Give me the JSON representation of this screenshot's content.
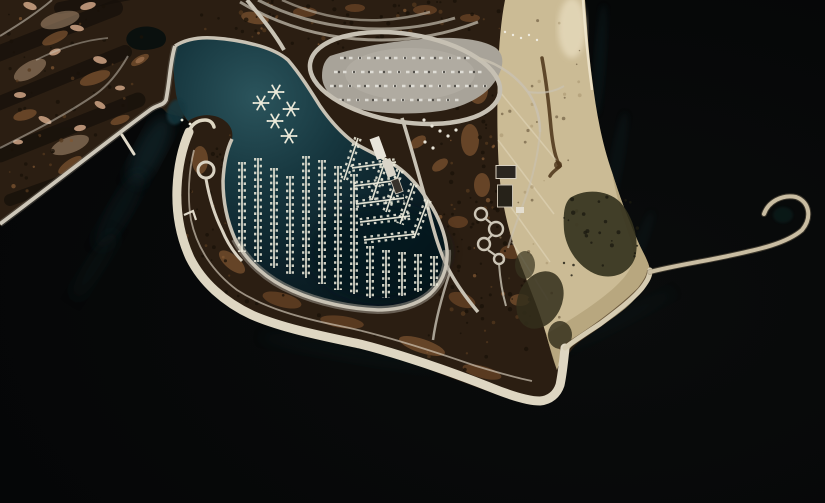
{
  "scene": {
    "type": "satellite-aerial-photograph",
    "description": "Aerial satellite view of a lakefront harbor: golf course at upper left, teardrop marina basin with star-shaped docks and boat piers, hooked peninsula breakwater with loop drive at its tip, looped parking lot and parkland at top, sandy beach strip at right, and a thin spiral breakwater curling into dark lake water",
    "features": [
      "golf-course",
      "marina-basin",
      "star-docks",
      "boat-piers",
      "hooked-peninsula",
      "harbor-entrance",
      "parking-lot",
      "loop-road",
      "parkland",
      "beach",
      "beach-point",
      "spiral-breakwater",
      "lake"
    ]
  },
  "palette": {
    "lake": "#040506",
    "lake_mid": "#0a0c0c",
    "teal_glow": "#11343c",
    "marina_light": "#2b545c",
    "marina_mid": "#16363e",
    "marina_deep": "#0c2129",
    "marina_darkest": "#071419",
    "land_base": "#2b1e12",
    "golf_dark": "#16100a",
    "rust": "#6e4627",
    "rust_light": "#7f5531",
    "sand_trap": "#c79d80",
    "sand_pale": "#b89a7c",
    "beach": "#cbbb95",
    "beach_dark": "#b3a379",
    "beach_bright": "#ecdfbf",
    "wet_brown": "#4e3b24",
    "veg_dark": "#35331e",
    "road": "#c8c2b4",
    "road_dim": "#9b958a",
    "promenade": "#ded6c2",
    "promenade_ne": "#d6ccb2",
    "breakwater": "#c9bda2",
    "parking": "#a8a399",
    "parking_light": "#b6b1a6",
    "building_light": "#e8e4da",
    "building_mid": "#d9d4c8",
    "building_dark": "#37322b",
    "boat_white": "#eceada",
    "pond": "#0a100e",
    "speckle_dark": "#1a1208",
    "speckle_rust": "#54381e",
    "speckle_sand": "#a4906a",
    "car_dark": "#3c3a36"
  },
  "marina": {
    "star_dock_count": 5,
    "star_docks": [
      [
        276,
        92
      ],
      [
        261,
        103
      ],
      [
        291,
        109
      ],
      [
        275,
        121
      ],
      [
        289,
        136
      ]
    ],
    "pier_count": 23,
    "piers_vertical": [
      [
        242,
        162,
        252
      ],
      [
        258,
        158,
        262
      ],
      [
        274,
        168,
        268
      ],
      [
        290,
        176,
        274
      ],
      [
        306,
        156,
        278
      ],
      [
        322,
        160,
        284
      ],
      [
        338,
        166,
        290
      ],
      [
        354,
        174,
        294
      ],
      [
        370,
        246,
        298
      ],
      [
        386,
        250,
        298
      ],
      [
        402,
        252,
        296
      ],
      [
        418,
        254,
        292
      ],
      [
        434,
        256,
        286
      ]
    ],
    "piers_slanted": [
      [
        352,
        168,
        396,
        162
      ],
      [
        354,
        186,
        400,
        180
      ],
      [
        356,
        204,
        404,
        198
      ],
      [
        360,
        222,
        410,
        216
      ],
      [
        364,
        240,
        416,
        234
      ],
      [
        414,
        184,
        400,
        224
      ],
      [
        428,
        200,
        414,
        238
      ],
      [
        386,
        158,
        372,
        200
      ],
      [
        400,
        170,
        386,
        212
      ],
      [
        358,
        138,
        344,
        180
      ]
    ],
    "loose_boats": [
      [
        182,
        120
      ],
      [
        190,
        124
      ]
    ]
  },
  "parking": {
    "car_rows": [
      [
        340,
        470,
        58
      ],
      [
        334,
        484,
        72
      ],
      [
        330,
        488,
        86
      ],
      [
        338,
        462,
        100
      ]
    ]
  },
  "golf": {
    "sand_traps": [
      [
        30,
        6,
        7,
        3.5,
        20
      ],
      [
        88,
        6,
        8,
        3.5,
        -15
      ],
      [
        77,
        28,
        7,
        3,
        10
      ],
      [
        55,
        52,
        6,
        3,
        -20
      ],
      [
        100,
        60,
        7,
        3.5,
        15
      ],
      [
        140,
        60,
        5,
        2.5,
        -30
      ],
      [
        20,
        95,
        6,
        3,
        0
      ],
      [
        45,
        120,
        7,
        3,
        25
      ],
      [
        80,
        128,
        6,
        3,
        -10
      ],
      [
        18,
        142,
        5,
        2.5,
        0
      ],
      [
        100,
        105,
        6,
        3,
        30
      ],
      [
        120,
        88,
        5,
        2.5,
        0
      ]
    ],
    "fairways": [
      [
        -5,
        55,
        115,
        8,
        16
      ],
      [
        -5,
        105,
        125,
        52,
        14
      ],
      [
        0,
        155,
        138,
        100,
        15
      ],
      [
        10,
        200,
        150,
        150,
        12
      ],
      [
        60,
        8,
        150,
        -10,
        12
      ]
    ],
    "pale_zones": [
      [
        60,
        20,
        20,
        8,
        -15
      ],
      [
        30,
        70,
        18,
        8,
        -30
      ],
      [
        70,
        145,
        20,
        8,
        -20
      ]
    ]
  },
  "rust_patches": [
    [
      55,
      38,
      14,
      5,
      -25
    ],
    [
      95,
      78,
      16,
      6,
      -20
    ],
    [
      140,
      60,
      10,
      4,
      -30
    ],
    [
      25,
      115,
      12,
      5,
      -15
    ],
    [
      70,
      165,
      14,
      5,
      -35
    ],
    [
      120,
      120,
      10,
      4,
      -20
    ],
    [
      255,
      18,
      14,
      6,
      10
    ],
    [
      305,
      12,
      12,
      5,
      0
    ],
    [
      355,
      8,
      10,
      4,
      0
    ],
    [
      425,
      10,
      12,
      5,
      0
    ],
    [
      470,
      18,
      10,
      4,
      0
    ],
    [
      478,
      90,
      10,
      14,
      0
    ],
    [
      470,
      140,
      9,
      16,
      0
    ],
    [
      482,
      185,
      8,
      12,
      0
    ],
    [
      458,
      222,
      10,
      6,
      0
    ],
    [
      512,
      252,
      12,
      7,
      0
    ],
    [
      462,
      300,
      14,
      7,
      20
    ],
    [
      520,
      300,
      10,
      6,
      0
    ],
    [
      200,
      160,
      8,
      14,
      0
    ],
    [
      232,
      262,
      16,
      7,
      40
    ],
    [
      282,
      300,
      20,
      7,
      15
    ],
    [
      342,
      322,
      22,
      6,
      8
    ],
    [
      422,
      346,
      24,
      7,
      18
    ],
    [
      482,
      372,
      20,
      6,
      15
    ],
    [
      418,
      142,
      9,
      5,
      -35
    ],
    [
      440,
      165,
      9,
      5,
      -35
    ]
  ],
  "speckle_regions": [
    [
      8,
      6,
      185,
      190,
      65
    ],
    [
      195,
      0,
      250,
      50,
      40
    ],
    [
      440,
      10,
      62,
      240,
      55
    ],
    [
      230,
      0,
      230,
      40,
      35
    ],
    [
      430,
      200,
      105,
      120,
      45
    ],
    [
      178,
      135,
      60,
      160,
      30
    ],
    [
      215,
      255,
      330,
      115,
      65
    ]
  ],
  "beach_speckle_region": [
    500,
    15,
    92,
    320,
    40
  ],
  "veg_speckle_region": [
    558,
    195,
    85,
    85,
    26
  ],
  "beach": {
    "umbrella_dots": [
      [
        505,
        32
      ],
      [
        513,
        35
      ],
      [
        521,
        38
      ],
      [
        529,
        35
      ],
      [
        537,
        40
      ]
    ]
  },
  "park": {
    "shelter_dots": [
      [
        424,
        120
      ],
      [
        432,
        126
      ],
      [
        440,
        131
      ],
      [
        448,
        136
      ],
      [
        425,
        142
      ],
      [
        433,
        148
      ],
      [
        456,
        130
      ]
    ]
  },
  "garden": {
    "circle_count": 4,
    "circles": [
      [
        481,
        214,
        6
      ],
      [
        496,
        229,
        7
      ],
      [
        484,
        244,
        6
      ],
      [
        499,
        259,
        5
      ]
    ]
  }
}
